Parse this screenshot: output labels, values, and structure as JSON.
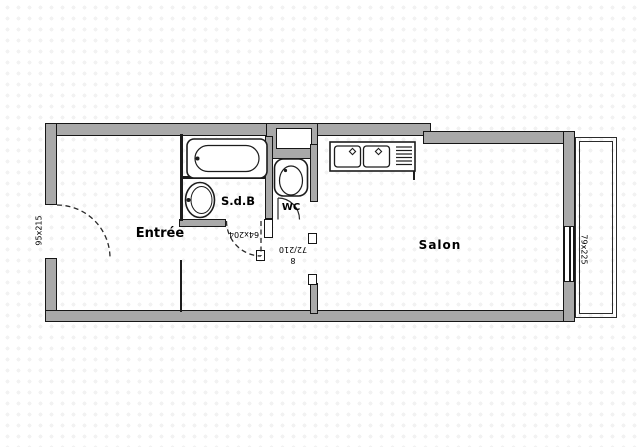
{
  "plan": {
    "type": "apartment-floor-plan",
    "rooms": [
      {
        "id": "entree",
        "label": "Entrée"
      },
      {
        "id": "sdb",
        "label": "S.d.B"
      },
      {
        "id": "wc",
        "label": "WC"
      },
      {
        "id": "salon",
        "label": "Salon"
      }
    ],
    "dimensions": [
      {
        "id": "entry-door",
        "label": "95x215"
      },
      {
        "id": "sdb-door",
        "label": "64x204"
      },
      {
        "id": "wc-door",
        "label": "72/210"
      },
      {
        "id": "wc-door-note",
        "label": "8"
      },
      {
        "id": "salon-window",
        "label": "79x225"
      }
    ],
    "fixtures": [
      "bathtub",
      "washbasin",
      "toilet",
      "kitchen-sink",
      "entry-door-swing",
      "sdb-door-swing",
      "wc-door-swing",
      "balcony"
    ],
    "colors": {
      "wall_fill": "#a9a9a9",
      "line": "#1c1c1c",
      "background": "#ffffff"
    }
  }
}
